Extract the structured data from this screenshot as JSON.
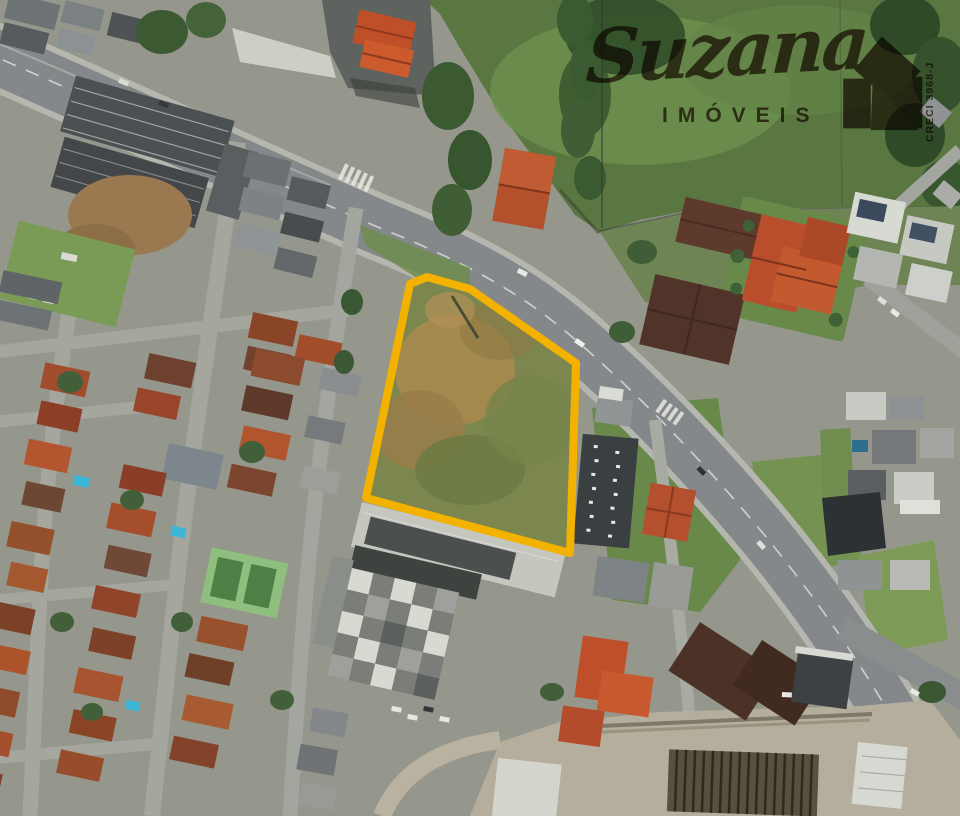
{
  "watermark": {
    "brand_script": "Suzana",
    "brand_subtitle": "IMÓVEIS",
    "creci": "CRECI 3968-J",
    "icon": "house-icon",
    "color": "#5E4434"
  },
  "highlight": {
    "points": "410,284 427,277 470,289 576,363 570,553 366,498",
    "stroke_color": "#F3B100",
    "stroke_width": "8",
    "fill_color": "#7C8750"
  },
  "palette": {
    "highlight_yellow": "#F3B100",
    "watermark_brown": "#5E4434",
    "field_green": "#5A7742",
    "roof_orange": "#C05A31",
    "road_gray": "#87898B",
    "pool_blue": "#3DB7D8"
  }
}
